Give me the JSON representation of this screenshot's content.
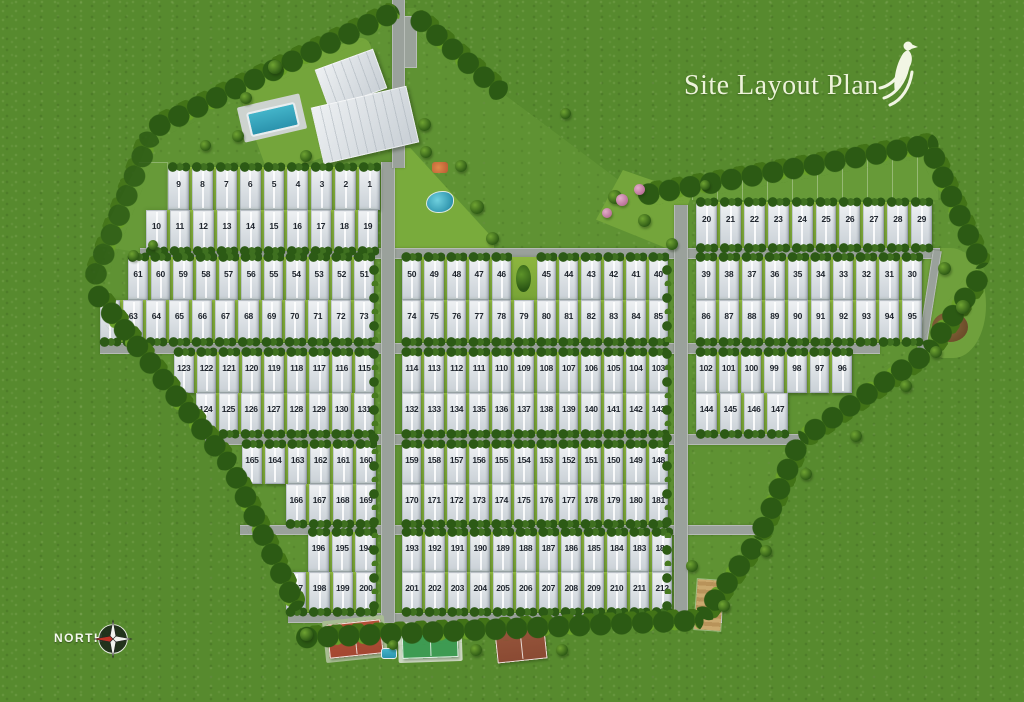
{
  "title": "Site Layout Plan",
  "compass": {
    "label": "NORTH"
  },
  "logo": {
    "icon": "bird-logo"
  },
  "colors": {
    "grass": "#578a2e",
    "site_grass": "#5f9233",
    "yard_green": "#8db63f",
    "road": "#9aa19b",
    "house": "#dde2e6",
    "tree_dark": "#2c5a14",
    "tree_light": "#69a028",
    "pool_blue": "#2b93ad",
    "court_red": "#b24a32",
    "court_green": "#3e9b52",
    "court_brown": "#8e4c33",
    "title_text": "#edf3da",
    "plot_number": "#20262e"
  },
  "site": {
    "rows": [
      {
        "id": "1-9",
        "x": 168,
        "y": 167,
        "w": 212,
        "h": 43,
        "bush": "top",
        "numbers": [
          "9",
          "8",
          "7",
          "6",
          "5",
          "4",
          "3",
          "2",
          "1"
        ]
      },
      {
        "id": "10-19",
        "x": 146,
        "y": 210,
        "w": 232,
        "h": 41,
        "bush": "bottom",
        "numbers": [
          "10",
          "11",
          "12",
          "13",
          "14",
          "15",
          "16",
          "17",
          "18",
          "19"
        ]
      },
      {
        "id": "20-29",
        "x": 696,
        "y": 202,
        "w": 236,
        "h": 46,
        "bush": "both",
        "numbers": [
          "20",
          "21",
          "22",
          "23",
          "24",
          "25",
          "26",
          "27",
          "28",
          "29"
        ]
      },
      {
        "id": "51-61",
        "x": 128,
        "y": 257,
        "w": 246,
        "h": 43,
        "bush": "top",
        "numbers": [
          "61",
          "60",
          "59",
          "58",
          "57",
          "56",
          "55",
          "54",
          "53",
          "52",
          "51"
        ]
      },
      {
        "id": "62-73",
        "x": 100,
        "y": 300,
        "w": 274,
        "h": 42,
        "bush": "bottom",
        "numbers": [
          "62",
          "63",
          "64",
          "65",
          "66",
          "67",
          "68",
          "69",
          "70",
          "71",
          "72",
          "73"
        ]
      },
      {
        "id": "40-50",
        "x": 402,
        "y": 257,
        "w": 266,
        "h": 43,
        "bush": "top",
        "numbers": [
          "50",
          "49",
          "48",
          "47",
          "46",
          "",
          "45",
          "44",
          "43",
          "42",
          "41",
          "40"
        ]
      },
      {
        "id": "74-85",
        "x": 402,
        "y": 300,
        "w": 266,
        "h": 42,
        "bush": "bottom",
        "numbers": [
          "74",
          "75",
          "76",
          "77",
          "78",
          "79",
          "80",
          "81",
          "82",
          "83",
          "84",
          "85"
        ]
      },
      {
        "id": "30-39",
        "x": 696,
        "y": 257,
        "w": 226,
        "h": 43,
        "bush": "top",
        "numbers": [
          "39",
          "38",
          "37",
          "36",
          "35",
          "34",
          "33",
          "32",
          "31",
          "30"
        ]
      },
      {
        "id": "86-95",
        "x": 696,
        "y": 300,
        "w": 226,
        "h": 42,
        "bush": "bottom",
        "numbers": [
          "86",
          "87",
          "88",
          "89",
          "90",
          "91",
          "92",
          "93",
          "94",
          "95"
        ]
      },
      {
        "id": "115-123",
        "x": 174,
        "y": 352,
        "w": 200,
        "h": 41,
        "bush": "top",
        "numbers": [
          "123",
          "122",
          "121",
          "120",
          "119",
          "118",
          "117",
          "116",
          "115"
        ]
      },
      {
        "id": "124-131",
        "x": 196,
        "y": 393,
        "w": 178,
        "h": 41,
        "bush": "bottom",
        "numbers": [
          "124",
          "125",
          "126",
          "127",
          "128",
          "129",
          "130",
          "131"
        ]
      },
      {
        "id": "103-114",
        "x": 402,
        "y": 352,
        "w": 266,
        "h": 41,
        "bush": "top",
        "numbers": [
          "114",
          "113",
          "112",
          "111",
          "110",
          "109",
          "108",
          "107",
          "106",
          "105",
          "104",
          "103"
        ]
      },
      {
        "id": "132-143",
        "x": 402,
        "y": 393,
        "w": 266,
        "h": 41,
        "bush": "bottom",
        "numbers": [
          "132",
          "133",
          "134",
          "135",
          "136",
          "137",
          "138",
          "139",
          "140",
          "141",
          "142",
          "143"
        ]
      },
      {
        "id": "96-102",
        "x": 696,
        "y": 352,
        "w": 156,
        "h": 41,
        "bush": "top",
        "numbers": [
          "102",
          "101",
          "100",
          "99",
          "98",
          "97",
          "96"
        ]
      },
      {
        "id": "144-147",
        "x": 696,
        "y": 393,
        "w": 92,
        "h": 41,
        "bush": "bottom",
        "numbers": [
          "144",
          "145",
          "146",
          "147"
        ]
      },
      {
        "id": "160-165",
        "x": 242,
        "y": 444,
        "w": 134,
        "h": 40,
        "bush": "top",
        "numbers": [
          "165",
          "164",
          "163",
          "162",
          "161",
          "160"
        ]
      },
      {
        "id": "166-169",
        "x": 286,
        "y": 484,
        "w": 90,
        "h": 40,
        "bush": "bottom",
        "numbers": [
          "166",
          "167",
          "168",
          "169"
        ]
      },
      {
        "id": "148-159",
        "x": 402,
        "y": 444,
        "w": 266,
        "h": 40,
        "bush": "top",
        "numbers": [
          "159",
          "158",
          "157",
          "156",
          "155",
          "154",
          "153",
          "152",
          "151",
          "150",
          "149",
          "148"
        ]
      },
      {
        "id": "170-181",
        "x": 402,
        "y": 484,
        "w": 266,
        "h": 40,
        "bush": "bottom",
        "numbers": [
          "170",
          "171",
          "172",
          "173",
          "174",
          "175",
          "176",
          "177",
          "178",
          "179",
          "180",
          "181"
        ]
      },
      {
        "id": "194-196",
        "x": 308,
        "y": 532,
        "w": 68,
        "h": 40,
        "bush": "top",
        "numbers": [
          "196",
          "195",
          "194"
        ]
      },
      {
        "id": "197-200",
        "x": 286,
        "y": 572,
        "w": 90,
        "h": 40,
        "bush": "bottom",
        "numbers": [
          "197",
          "198",
          "199",
          "200"
        ]
      },
      {
        "id": "182-193",
        "x": 402,
        "y": 532,
        "w": 270,
        "h": 40,
        "bush": "top",
        "numbers": [
          "193",
          "192",
          "191",
          "190",
          "189",
          "188",
          "187",
          "186",
          "185",
          "184",
          "183",
          "182"
        ]
      },
      {
        "id": "201-212",
        "x": 402,
        "y": 572,
        "w": 270,
        "h": 40,
        "bush": "bottom",
        "numbers": [
          "201",
          "202",
          "203",
          "204",
          "205",
          "206",
          "207",
          "208",
          "209",
          "210",
          "211",
          "212"
        ]
      }
    ]
  }
}
